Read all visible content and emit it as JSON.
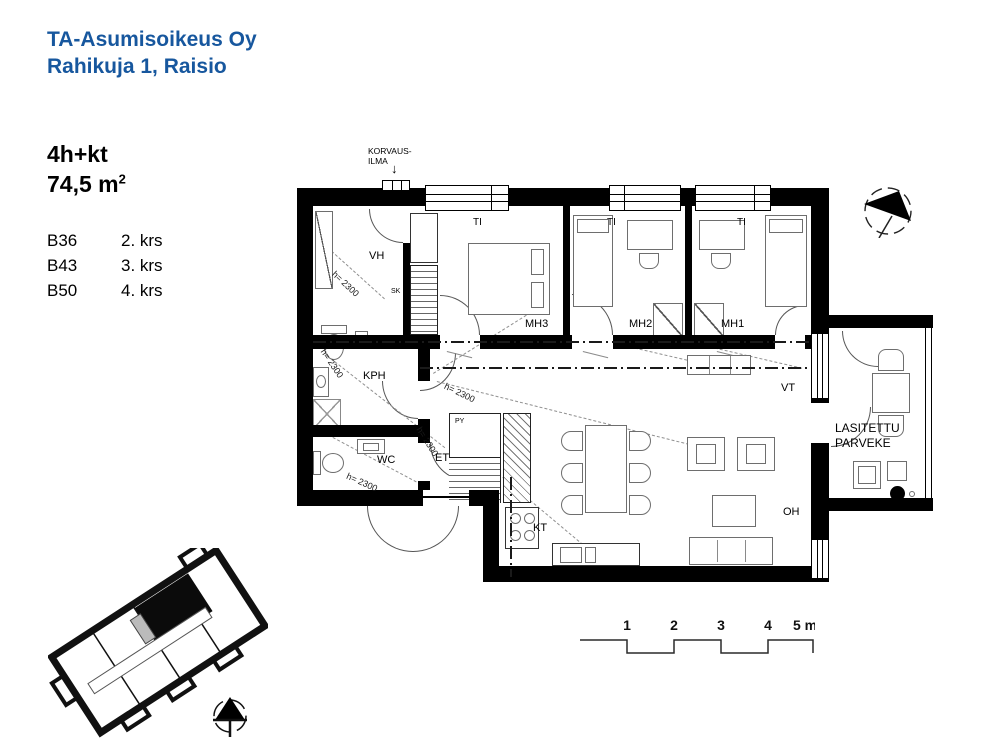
{
  "header": {
    "company": "TA-Asumisoikeus Oy",
    "address": "Rahikuja 1, Raisio"
  },
  "apartment": {
    "type": "4h+kt",
    "area": "74,5 m",
    "area_exponent": "2",
    "units": [
      {
        "id": "B36",
        "floor": "2. krs"
      },
      {
        "id": "B43",
        "floor": "3. krs"
      },
      {
        "id": "B50",
        "floor": "4. krs"
      }
    ]
  },
  "plan": {
    "supply_air_line1": "KORVAUS-",
    "supply_air_line2": "ILMA",
    "supply_air_arrow": "↓",
    "rooms": {
      "vh": "VH",
      "sk": "SK",
      "kph": "KPH",
      "wc": "WC",
      "et": "ET",
      "py": "PY",
      "kt": "KT",
      "mh1": "MH1",
      "mh2": "MH2",
      "mh3": "MH3",
      "oh": "OH",
      "vt": "VT",
      "balcony_line1": "LASITETTU",
      "balcony_line2": "PARVEKE"
    },
    "window_label": "TI",
    "ceiling_height_label": "h= 2300"
  },
  "scale_bar": {
    "ticks": [
      "1",
      "2",
      "3",
      "4",
      "5 m"
    ]
  },
  "colors": {
    "brand_blue": "#17579e",
    "line_black": "#000000"
  }
}
